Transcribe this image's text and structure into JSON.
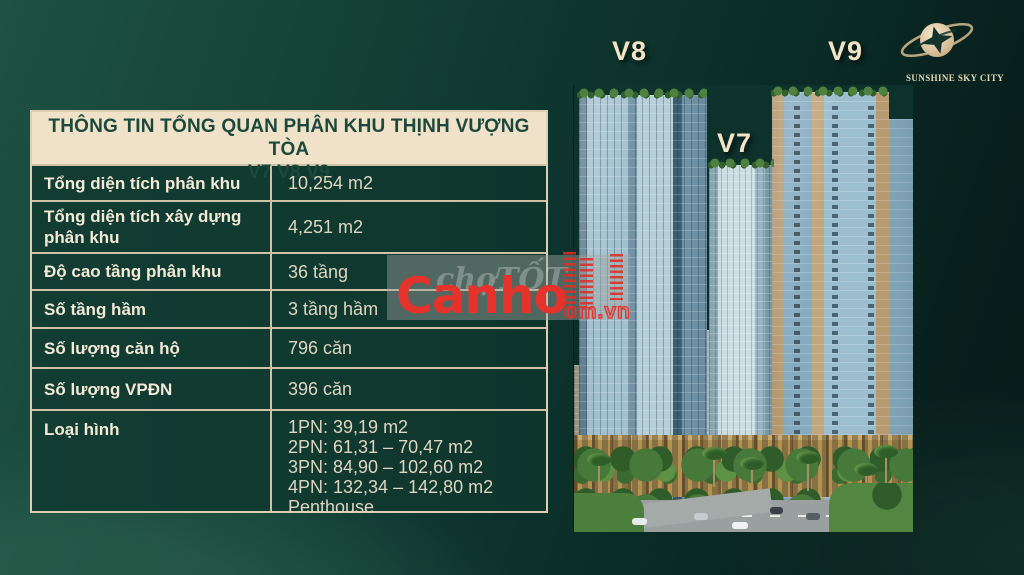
{
  "table": {
    "title_line1": "THÔNG TIN TỔNG QUAN PHÂN KHU THỊNH VƯỢNG TÒA",
    "title_line2": "V7 V8 V9",
    "rows": [
      {
        "label": "Tổng diện tích phân khu",
        "value": "10,254 m2"
      },
      {
        "label": "Tổng diện tích xây dựng phân khu",
        "value": "4,251 m2"
      },
      {
        "label": "Độ cao tầng phân khu",
        "value": "36 tầng"
      },
      {
        "label": "Số tầng hầm",
        "value": "3 tầng hầm"
      },
      {
        "label": "Số lượng căn hộ",
        "value": "796 căn"
      },
      {
        "label": "Số lượng VPĐN",
        "value": "396 căn"
      },
      {
        "label": "Loại hình",
        "value_lines": [
          "1PN: 39,19 m2",
          "2PN: 61,31 – 70,47 m2",
          "3PN: 84,90 – 102,60 m2",
          "4PN: 132,34 – 142,80 m2",
          "Penthouse"
        ]
      }
    ]
  },
  "tower_labels": {
    "v8": "V8",
    "v7": "V7",
    "v9": "V9"
  },
  "logo": {
    "text": "SUNSHINE SKY CITY"
  },
  "watermark": {
    "brand": "Canho",
    "domain": "om.vn",
    "ghost_text": "chợTỐT"
  },
  "colors": {
    "header_bg": "#f0e1c9",
    "header_text": "#1b4a3d",
    "row_bg": "#113b31",
    "table_border": "#d9cbb1",
    "label_text": "#f2e9d6",
    "value_text": "#ded6c1",
    "page_green_light": "#1d5244",
    "page_green_dark": "#071c1a",
    "watermark_red": "#e5332c",
    "tower_label_cream": "#f3e4c6",
    "logo_gold": "#e7d7b5"
  }
}
